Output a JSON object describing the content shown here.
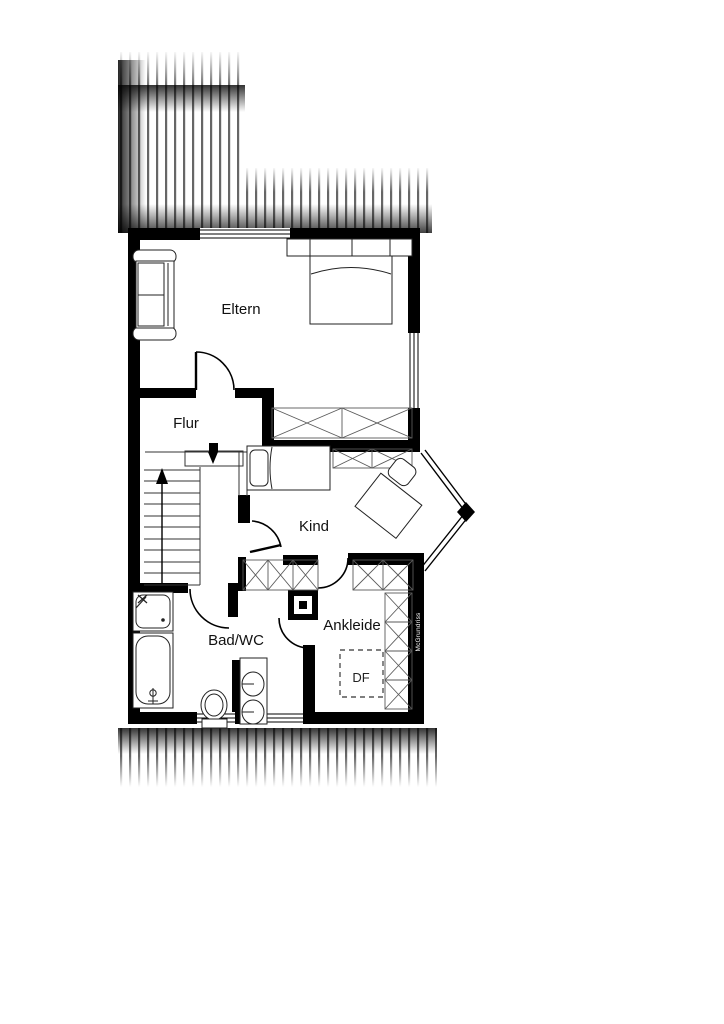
{
  "rooms": {
    "eltern": "Eltern",
    "flur": "Flur",
    "kind": "Kind",
    "bad": "Bad/WC",
    "ankleide": "Ankleide"
  },
  "annotations": {
    "roof_window": "DF",
    "watermark": "McGrundriss"
  },
  "colors": {
    "wall": "#000000",
    "background": "#ffffff",
    "hatch_line": "#666666",
    "furniture_line": "#222222",
    "wardrobe_line": "#5a5a5a"
  }
}
